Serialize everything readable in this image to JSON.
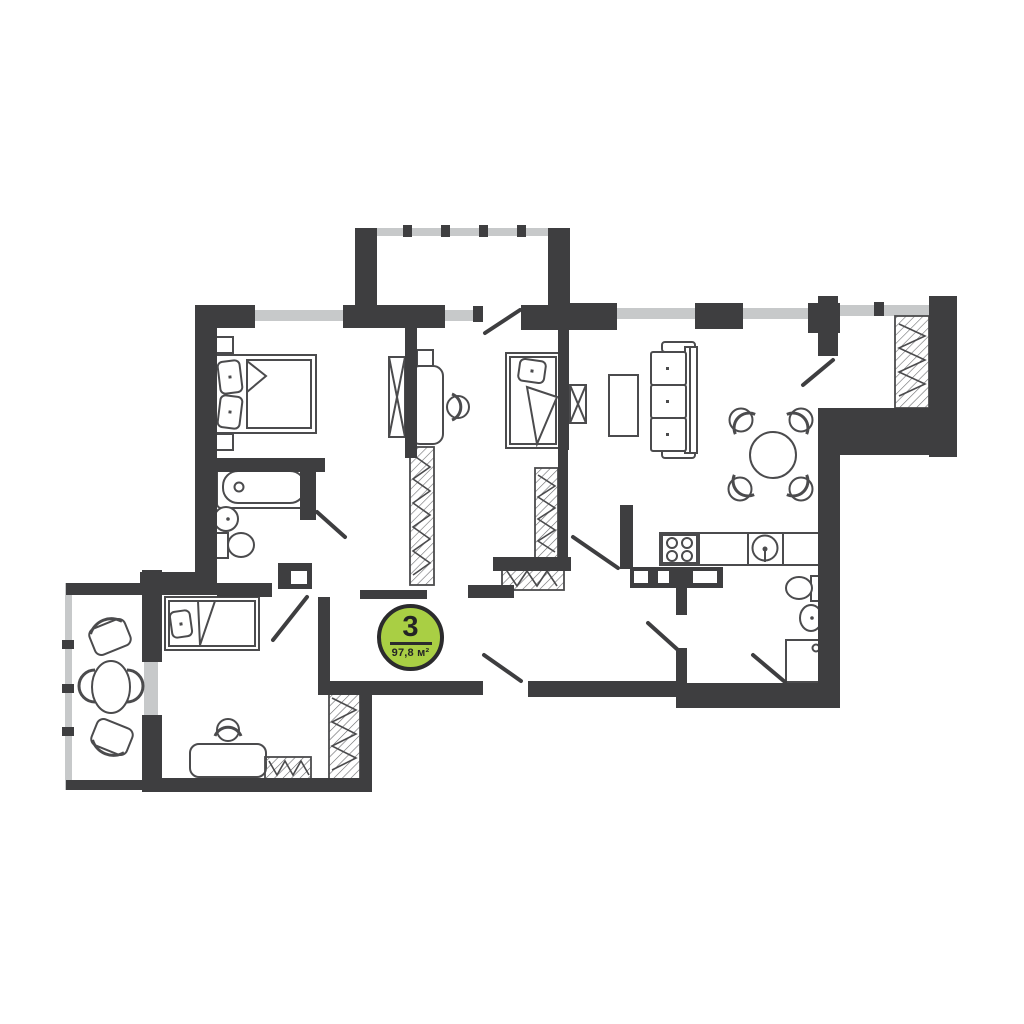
{
  "badge": {
    "rooms": "3",
    "area": "97,8 м²"
  },
  "colors": {
    "wall": "#3e3e40",
    "window": "#c7c9ca",
    "badge_fill": "#a9cf44",
    "badge_border": "#2b2b2d",
    "furniture_line": "#4b4b4d",
    "background": "#ffffff"
  },
  "floor_plan": {
    "type": "apartment-floor-plan",
    "rooms_count": "3",
    "total_area": "97,8 м²",
    "rooms": [
      {
        "name": "bedroom-master",
        "furniture": [
          "double-bed",
          "pillows",
          "nightstand",
          "nightstand",
          "mirror-wardrobe"
        ]
      },
      {
        "name": "bedroom-kids",
        "furniture": [
          "single-bed",
          "desk",
          "desk-chair",
          "wardrobe",
          "wardrobe"
        ]
      },
      {
        "name": "living-room-kitchen",
        "furniture": [
          "sofa",
          "coffee-table",
          "round-dining-table",
          "dining-chairs",
          "kitchen-counter",
          "cooktop",
          "kitchen-sink",
          "mirror-wardrobe"
        ]
      },
      {
        "name": "bedroom-bottom",
        "furniture": [
          "single-bed",
          "desk",
          "desk-chair",
          "wardrobe",
          "built-in-wardrobe"
        ]
      },
      {
        "name": "bathroom",
        "furniture": [
          "bathtub",
          "washbasin",
          "toilet"
        ]
      },
      {
        "name": "shower-room",
        "furniture": [
          "toilet",
          "washbasin",
          "shower-tray"
        ]
      },
      {
        "name": "wardrobe-room",
        "furniture": [
          "wardrobe"
        ]
      },
      {
        "name": "balcony-top",
        "furniture": []
      },
      {
        "name": "balcony-left",
        "furniture": [
          "oval-table",
          "armchair",
          "armchair"
        ]
      },
      {
        "name": "entrance-hall",
        "furniture": [
          "wardrobe",
          "shoe-cabinet"
        ]
      }
    ]
  }
}
